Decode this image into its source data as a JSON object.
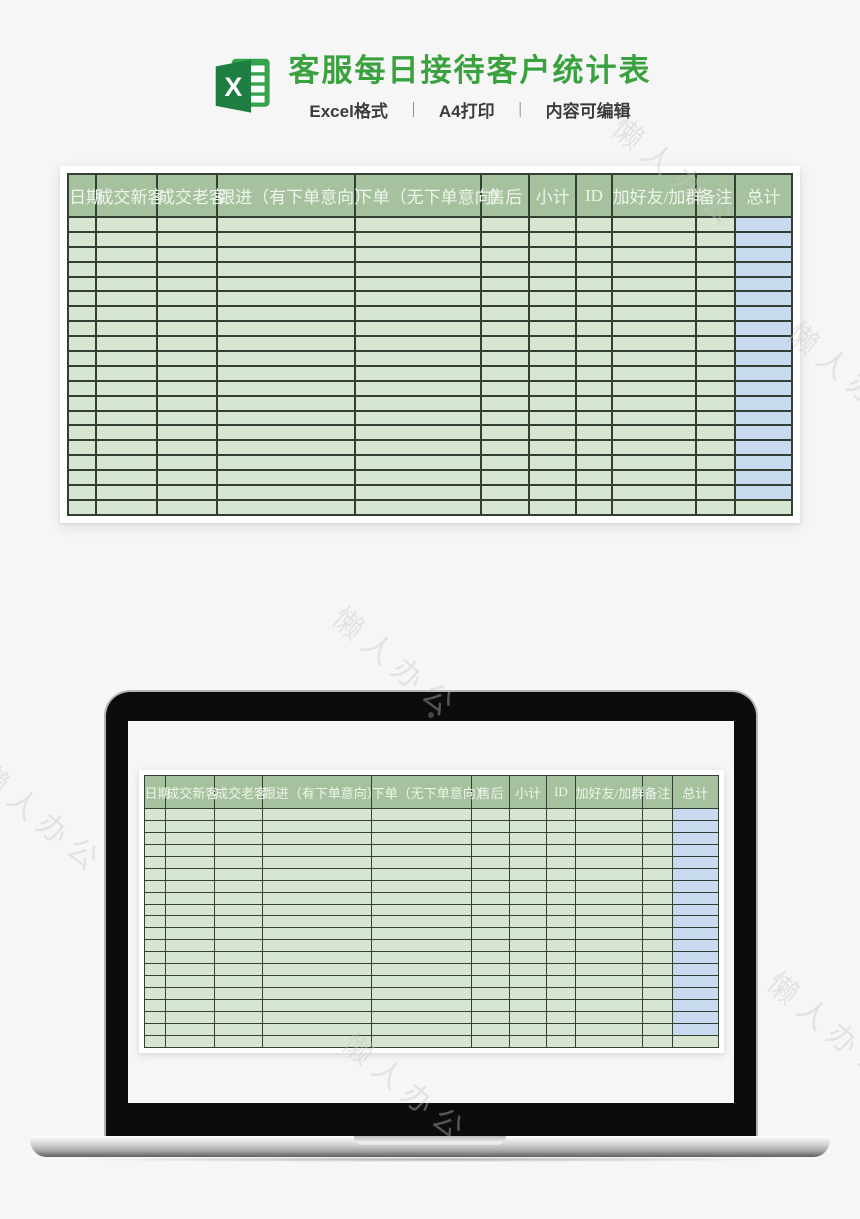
{
  "hero": {
    "title": "客服每日接待客户统计表",
    "subtitle_parts": [
      "Excel格式",
      "A4打印",
      "内容可编辑"
    ],
    "separator": "｜"
  },
  "colors": {
    "title_green": "#3aa13f",
    "header_bg": "#a6c19e",
    "header_text": "#eef5ea",
    "cell_green": "#d7e6d1",
    "cell_blue": "#c7daee",
    "grid_border": "#333f33",
    "excel_icon_dark": "#1e7e41",
    "excel_icon_light": "#36a24c"
  },
  "sheet": {
    "columns": [
      "日期",
      "成交新客",
      "成交老客",
      "跟进（有下单意向）",
      "下单（无下单意向）",
      "售后",
      "小计",
      "ID",
      "加好友/加群",
      "备注",
      "总计"
    ],
    "row_count": 20,
    "col_widths_pct": [
      3.8,
      8.5,
      8.3,
      19.0,
      17.5,
      6.6,
      6.5,
      4.9,
      11.7,
      5.3,
      7.9
    ],
    "total_column_index": 10
  },
  "watermark": {
    "text": "懒人办公"
  }
}
